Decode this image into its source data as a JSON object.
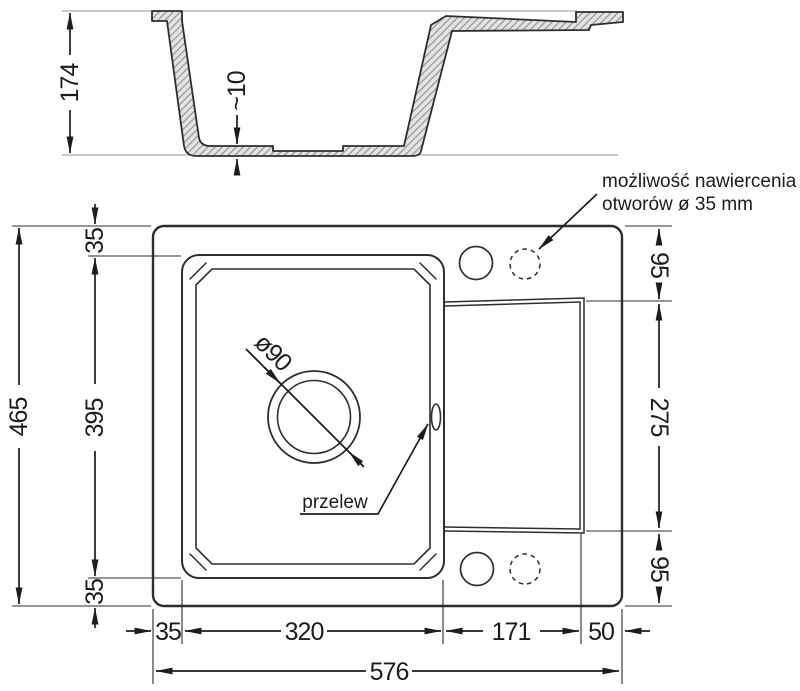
{
  "drawing": {
    "type": "sink-technical-drawing",
    "units": "mm"
  },
  "dims": {
    "section_height": "174",
    "bottom_thickness": "~10",
    "total_height": "465",
    "bowl_length": "395",
    "margin_top": "35",
    "margin_bottom": "35",
    "margin_left": "35",
    "bowl_width": "320",
    "drainer_width": "171",
    "ledge_width": "50",
    "total_width": "576",
    "right_top": "95",
    "right_middle": "275",
    "right_bottom": "95",
    "drain_diameter": "ø90"
  },
  "labels": {
    "drill_note_line1": "możliwość nawiercenia",
    "drill_note_line2": "otworów ø 35 mm",
    "overflow": "przelew"
  },
  "colors": {
    "line": "#1c1c1c",
    "outline": "#2e2e2e",
    "hatch_fill": "#e3e3e3",
    "hatch_line": "#8f8f8f",
    "background": "#ffffff"
  }
}
